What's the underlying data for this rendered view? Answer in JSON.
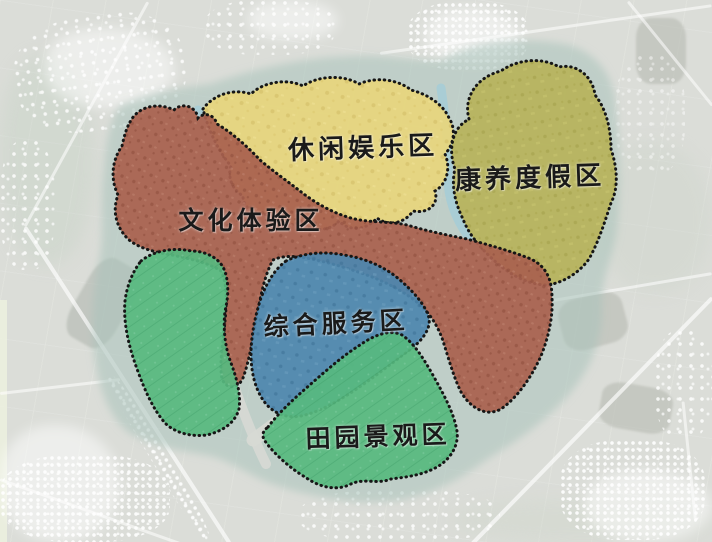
{
  "map": {
    "type": "functional-zoning-satellite-map",
    "zones": [
      {
        "id": "leisure",
        "label": "休闲娱乐区",
        "color": "#e8d67c"
      },
      {
        "id": "wellness",
        "label": "康养度假区",
        "color": "#b7b35a"
      },
      {
        "id": "culture",
        "label": "文化体验区",
        "color": "#a9614f"
      },
      {
        "id": "service",
        "label": "综合服务区",
        "color": "#4d86ae"
      },
      {
        "id": "pastoral",
        "label": "田园景观区",
        "color": "#57b97f"
      }
    ],
    "style": {
      "background": "#dbddd8",
      "site_buffer": "#a7c3b9",
      "zone_border": "#161616",
      "water_channel": "#a6cdd6",
      "road": "#d7d9d4",
      "label_color": "#1a1a1a"
    }
  }
}
